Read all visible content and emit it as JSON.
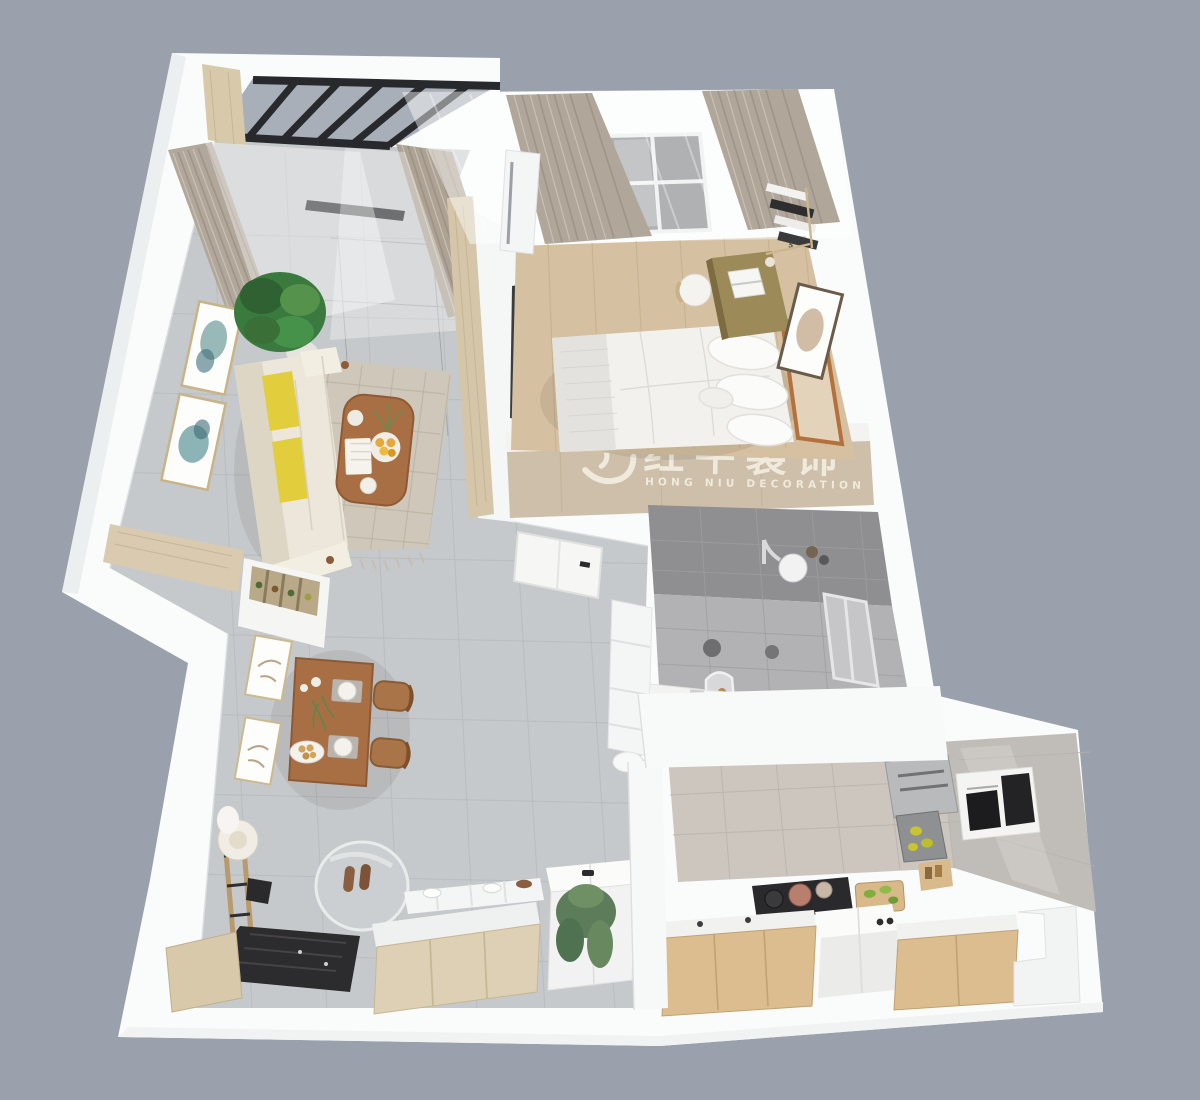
{
  "scene": {
    "type": "3d-floorplan-render",
    "view": "top-down isometric cutaway",
    "subject": "one-bedroom apartment interior"
  },
  "watermark": {
    "brand_cn": "红牛装饰",
    "brand_en": "HONG NIU DECORATION",
    "registered_mark": "®",
    "logo": "bull-swoosh-logo",
    "color": "#f3eee1"
  },
  "bedroom_decor": {
    "book_spine_label": "5"
  },
  "palette": {
    "background": "#9aa0ac",
    "wall_white": "#fafbfb",
    "wall_shade": "#e9ebec",
    "floor_tile": "#c6c9cb",
    "wood_furniture": "#a96f44",
    "light_wood": "#d5c6a9",
    "bedroom_floor": "#d5c1a2",
    "accent_yellow": "#e2ce3c",
    "curtain_taupe": "#b1a79a",
    "bathroom_tile": "#a3a3a6",
    "kitchen_cabinet": "#dcbd8f",
    "black_frame": "#2a2c2e",
    "plant_green": "#47924a",
    "rug_beige": "#cfc8ba"
  },
  "rooms": {
    "balcony": {
      "label": "balcony",
      "items": [
        "black-framed-glazing",
        "sliding-door-track",
        "sheer-curtain",
        "taupe-curtain",
        "wood-door-frame",
        "patterned-tile-floor"
      ]
    },
    "living_room": {
      "label": "living room",
      "items": [
        "cream-sofa",
        "yellow-pillows",
        "wood-coffee-table",
        "fruit-plate",
        "open-book",
        "area-rug",
        "potted-plant",
        "wall-art-frames",
        "window-nook-wood-counter"
      ]
    },
    "dining_area": {
      "label": "dining area",
      "items": [
        "wood-dining-table",
        "two-wood-chairs",
        "place-settings",
        "centerpiece-plant",
        "bread-plate",
        "wine-rack-console",
        "wall-art-frames"
      ]
    },
    "hallway": {
      "label": "hallway",
      "items": [
        "gray-tile-floor",
        "bathroom-door",
        "storage-cabinet"
      ]
    },
    "bedroom": {
      "label": "bedroom",
      "items": [
        "double-bed",
        "white-bedding",
        "pillows",
        "wood-headboard",
        "brass-desk",
        "laptop",
        "desk-chair",
        "wall-book-shelves",
        "wall-art-frame",
        "air-conditioner",
        "curtains",
        "window",
        "wood-plank-floor",
        "wardrobe-band"
      ]
    },
    "bathroom": {
      "label": "bathroom",
      "items": [
        "gray-wall-tiles",
        "shower-head",
        "arched-mirror",
        "vanity-counter",
        "window",
        "towel-rings"
      ]
    },
    "kitchen": {
      "label": "kitchen",
      "items": [
        "tiled-walls",
        "built-in-oven-column",
        "range-hood",
        "gas-stove",
        "cooktop-with-pots",
        "cutting-board",
        "wood-base-cabinets",
        "white-island-cube",
        "stepped-counter"
      ]
    },
    "entryway": {
      "label": "entryway",
      "items": [
        "round-mirror",
        "black-doormat",
        "shoe-cabinet",
        "slippers",
        "laundry-box-with-plant",
        "coat-rack-ladder",
        "hat",
        "wood-bench"
      ]
    }
  }
}
